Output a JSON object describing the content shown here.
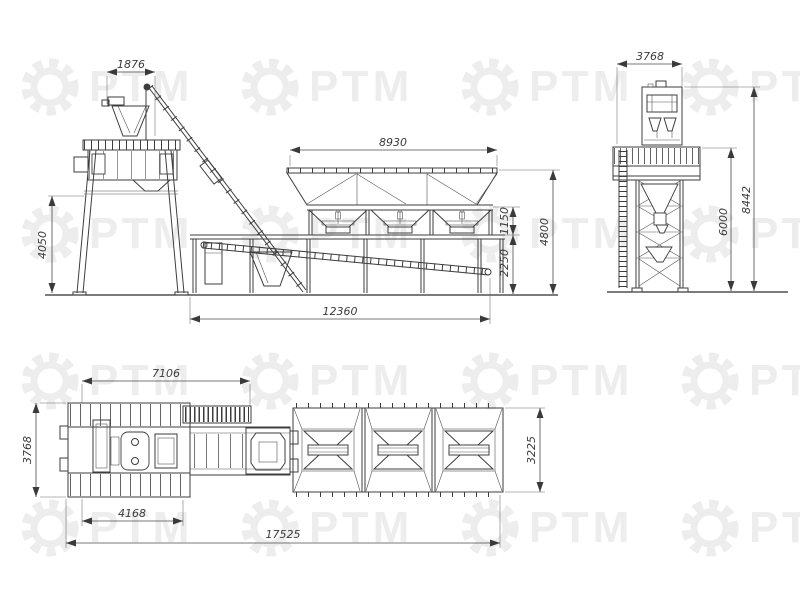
{
  "watermark": {
    "text": "РТМ",
    "color": "#ededed"
  },
  "drawing": {
    "side_view": {
      "dims": {
        "skip_hopper_width": "1876",
        "bins_length": "8930",
        "frame_height": "4050",
        "bins_discharge": "1150",
        "clearance": "2250",
        "bins_total_height": "4800",
        "base_length": "12360"
      }
    },
    "end_view": {
      "dims": {
        "top_width": "3768",
        "platform_height": "6000",
        "overall_height": "8442"
      }
    },
    "plan_view": {
      "dims": {
        "mixer_section_length": "7106",
        "overall_width": "3768",
        "bins_width": "3225",
        "support_spacing": "4168",
        "overall_length": "17525"
      }
    }
  }
}
